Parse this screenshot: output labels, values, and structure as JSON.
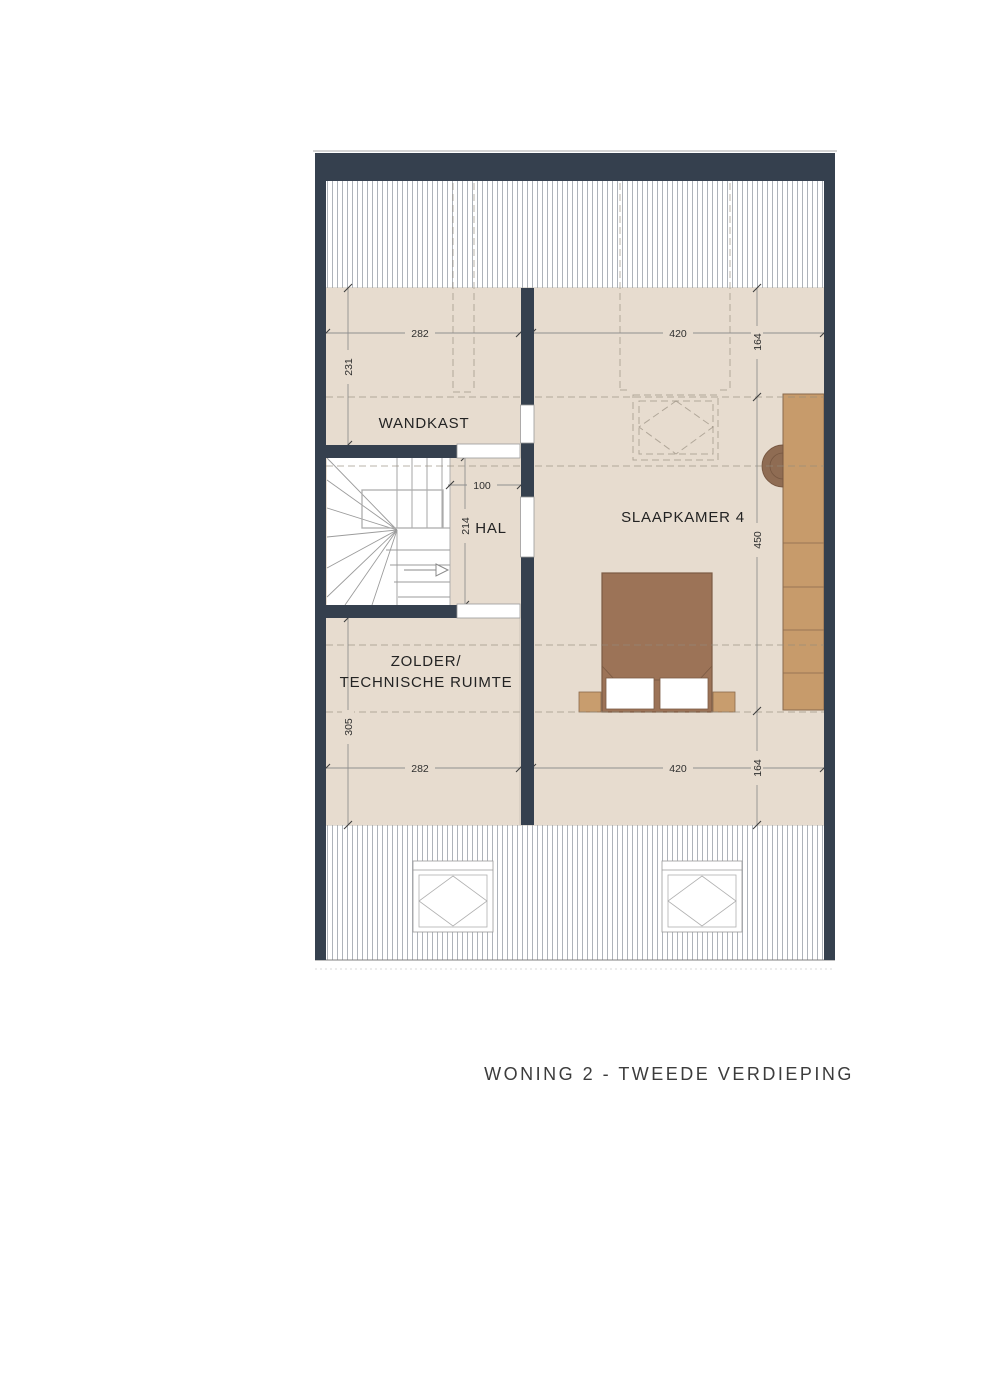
{
  "title": "WONING 2 - TWEEDE VERDIEPING",
  "rooms": {
    "wandkast": {
      "label": "WANDKAST"
    },
    "hal": {
      "label": "HAL"
    },
    "slaapkamer4": {
      "label": "SLAAPKAMER 4"
    },
    "zolder": {
      "line1": "ZOLDER/",
      "line2": "TECHNISCHE RUIMTE"
    }
  },
  "dimensions": {
    "top_width_left": "282",
    "top_width_right": "420",
    "right_depth_top": "164",
    "right_depth_middle": "450",
    "right_depth_bottom": "164",
    "left_depth_wandkast": "231",
    "hal_width": "100",
    "hal_depth": "214",
    "left_depth_zolder": "305",
    "bottom_width_left": "282",
    "bottom_width_right": "420",
    "bottom_right_depth": "164"
  },
  "colors": {
    "wall": "#35404e",
    "floor": "#e7dccf",
    "wood": "#c79b6b",
    "bed": "#9c7357",
    "chair": "#8f6c53"
  }
}
